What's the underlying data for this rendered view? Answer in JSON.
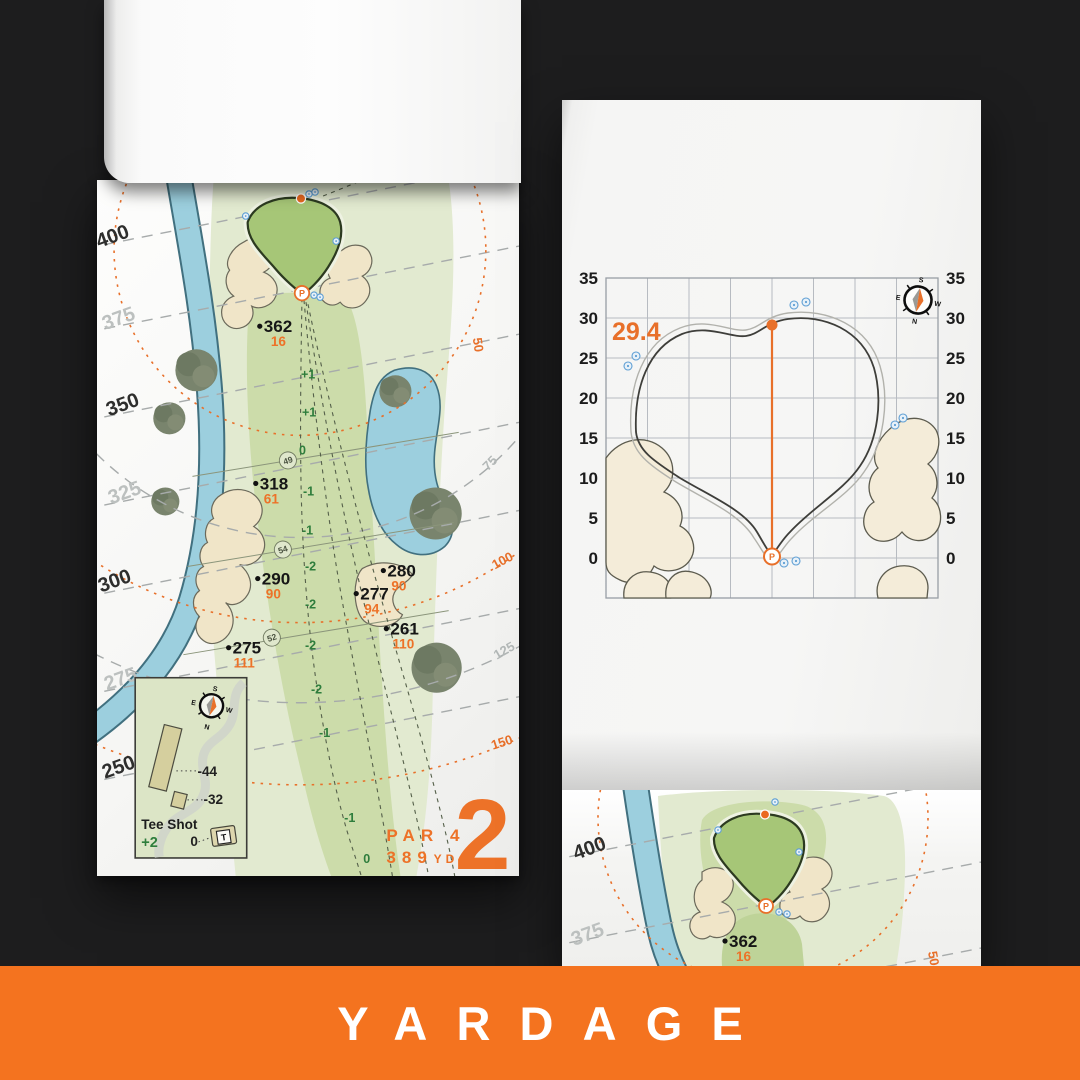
{
  "banner": {
    "label": "YARDAGE",
    "bg_color": "#f4731f"
  },
  "colors": {
    "accent_orange": "#e8702a",
    "banner_orange": "#f4731f",
    "water": "#9ccfde",
    "sand": "#f0e5c8",
    "green_surface": "#a6c677",
    "fairway": "#ccdcaa",
    "elevation_green": "#2e7d3c",
    "background": "#1d1d1e"
  },
  "compass_rose": {
    "n": "N",
    "s": "S",
    "e": "E",
    "w": "W"
  },
  "left_page": {
    "hole": {
      "number": "2",
      "par": "PAR 4",
      "yards": "389",
      "unit": "YD"
    },
    "pin": "P",
    "distance_labels": [
      "400",
      "375",
      "350",
      "325",
      "300",
      "275",
      "250"
    ],
    "arc_labels": [
      "50",
      "75",
      "100",
      "125",
      "150"
    ],
    "markers": [
      {
        "carry": "362",
        "remain": "16"
      },
      {
        "carry": "318",
        "remain": "61"
      },
      {
        "carry": "290",
        "remain": "90"
      },
      {
        "carry": "280",
        "remain": "90"
      },
      {
        "carry": "277",
        "remain": "94"
      },
      {
        "carry": "261",
        "remain": "110"
      },
      {
        "carry": "275",
        "remain": "111"
      }
    ],
    "elevations": [
      "+1",
      "+1",
      "0",
      "-1",
      "-1",
      "-2",
      "-2",
      "-2",
      "-2",
      "-1",
      "-1",
      "0"
    ],
    "sections": [
      "49",
      "54",
      "52"
    ],
    "tee_inset": {
      "title": "Tee Shot",
      "score": "+2",
      "back_tee": "-44",
      "forward_tee": "-32",
      "tee_zero": "0",
      "tee_icon": "T"
    }
  },
  "right_page": {
    "depth": "29.4",
    "pin": "P",
    "axis": [
      "35",
      "30",
      "25",
      "20",
      "15",
      "10",
      "5",
      "0"
    ]
  },
  "next_page": {
    "distance_labels": [
      "400",
      "375"
    ],
    "arc_label": "50",
    "pin": "P",
    "marker": {
      "carry": "362",
      "remain": "16"
    }
  }
}
